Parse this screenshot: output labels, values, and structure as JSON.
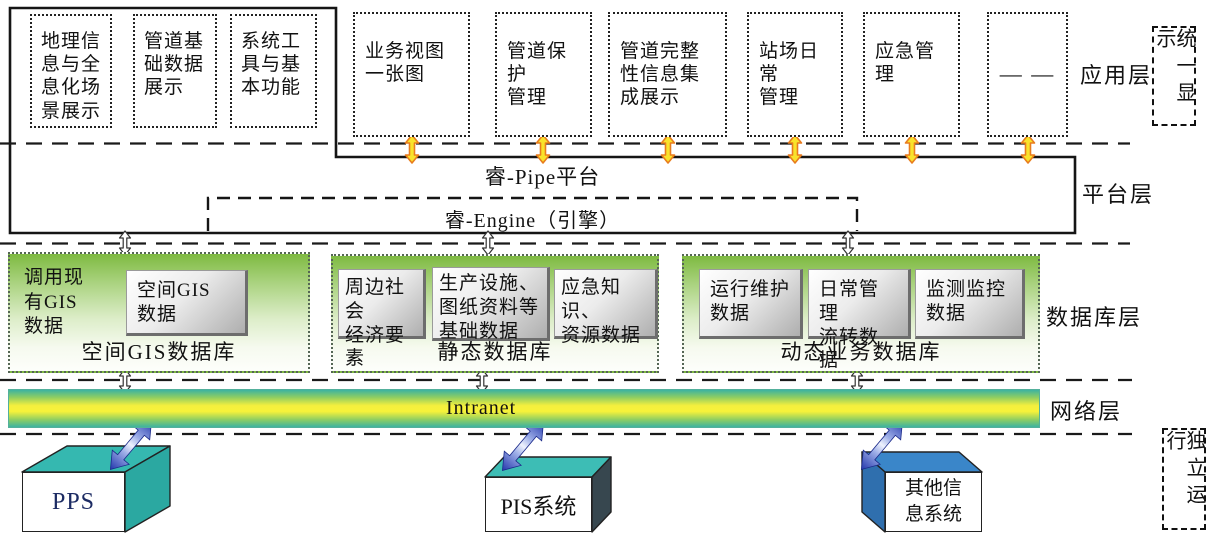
{
  "colors": {
    "db_green": "#7eba41",
    "intranet_yellow": "#f7f23a",
    "intranet_teal": "#3eb3a0",
    "pps_teal": "#35b8b0",
    "other_blue": "#3a86c9",
    "arrow_orange": "#e87c1e",
    "arrow_yellow": "#f9e32b",
    "arrow_blue": "#2336ac"
  },
  "app_layer": {
    "label": "应用层",
    "unified_display": "统一显示",
    "grouped_modules": [
      "地理信\n息与全\n息化场\n景展示",
      "管道基\n础数据\n展示",
      "系统工\n具与基\n本功能"
    ],
    "modules": [
      "业务视图\n一张图",
      "管道保护\n管理",
      "管道完整\n性信息集\n成展示",
      "站场日常\n管理",
      "应急管理",
      "— —"
    ]
  },
  "platform_layer": {
    "label": "平台层",
    "pipe": "睿-Pipe平台",
    "engine": "睿-Engine（引擎）"
  },
  "database_layer": {
    "label": "数据库层",
    "gis_note": "调用现\n有GIS\n数据",
    "databases": [
      {
        "name": "空间GIS数据库",
        "items": [
          "空间GIS\n数据"
        ]
      },
      {
        "name": "静态数据库",
        "items": [
          "周边社会\n经济要素",
          "生产设施、\n图纸资料等\n基础数据",
          "应急知识、\n资源数据"
        ]
      },
      {
        "name": "动态业务数据库",
        "items": [
          "运行维护\n数据",
          "日常管理\n流转数据",
          "监测监控\n数据"
        ]
      }
    ]
  },
  "network_layer": {
    "label": "网络层",
    "bus": "Intranet"
  },
  "bottom_layer": {
    "independent_run": "独立运行",
    "systems": [
      "PPS",
      "PIS系统",
      "其他信\n息系统"
    ]
  }
}
